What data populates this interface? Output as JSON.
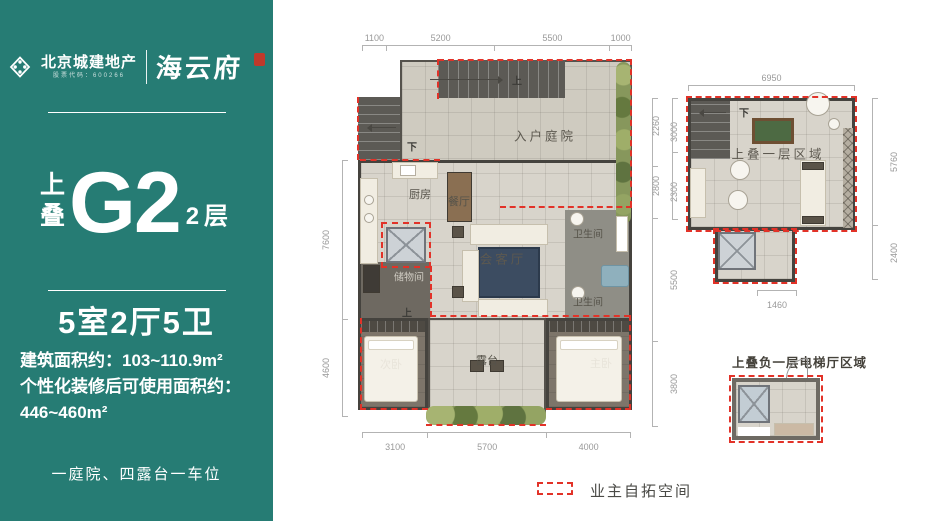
{
  "colors": {
    "brand_teal": "#267c74",
    "dash_red": "#e23228",
    "seal_red": "#c0392b"
  },
  "sidebar": {
    "brand": "北京城建地产",
    "brand_sub": "股票代码：600266",
    "project": "海云府",
    "unit_prefix": [
      "上",
      "叠"
    ],
    "unit_code": "G2",
    "unit_floor": "2层",
    "rooms_summary": "5室2厅5卫",
    "area_line1": "建筑面积约：103~110.9m²",
    "area_line2": "个性化装修后可使用面积约：",
    "area_line3": "446~460m²",
    "slogan": "一庭院、四露台一车位"
  },
  "main_plan": {
    "dims_top": [
      "1100",
      "5200",
      "5500",
      "1000"
    ],
    "dims_bottom": [
      "3100",
      "5700",
      "4000"
    ],
    "dims_left": [
      "7600",
      "4600"
    ],
    "dims_right": [
      "3000",
      "2300",
      "5500",
      "3800"
    ],
    "rooms": {
      "courtyard": "入户庭院",
      "kitchen": "厨房",
      "dining": "餐厅",
      "living": "会客厅",
      "bath_upper": "卫生间",
      "bath_lower": "卫生间",
      "storage": "储物间",
      "bedroom2": "次卧",
      "terrace": "露台",
      "master": "主卧"
    },
    "stair_up_top": "上",
    "stair_down_left": "下",
    "stair_up_bottom": "上"
  },
  "upper_plan": {
    "title": "上叠一层区域",
    "dims_top": [
      "6950"
    ],
    "dims_left": [
      "2260",
      "2800"
    ],
    "dims_right": [
      "5760",
      "2400"
    ],
    "dims_bottom": [
      "1460"
    ],
    "stair_down": "下"
  },
  "basement_plan": {
    "title": "上叠负一层电梯厅区域"
  },
  "legend": {
    "label": "业主自拓空间"
  }
}
